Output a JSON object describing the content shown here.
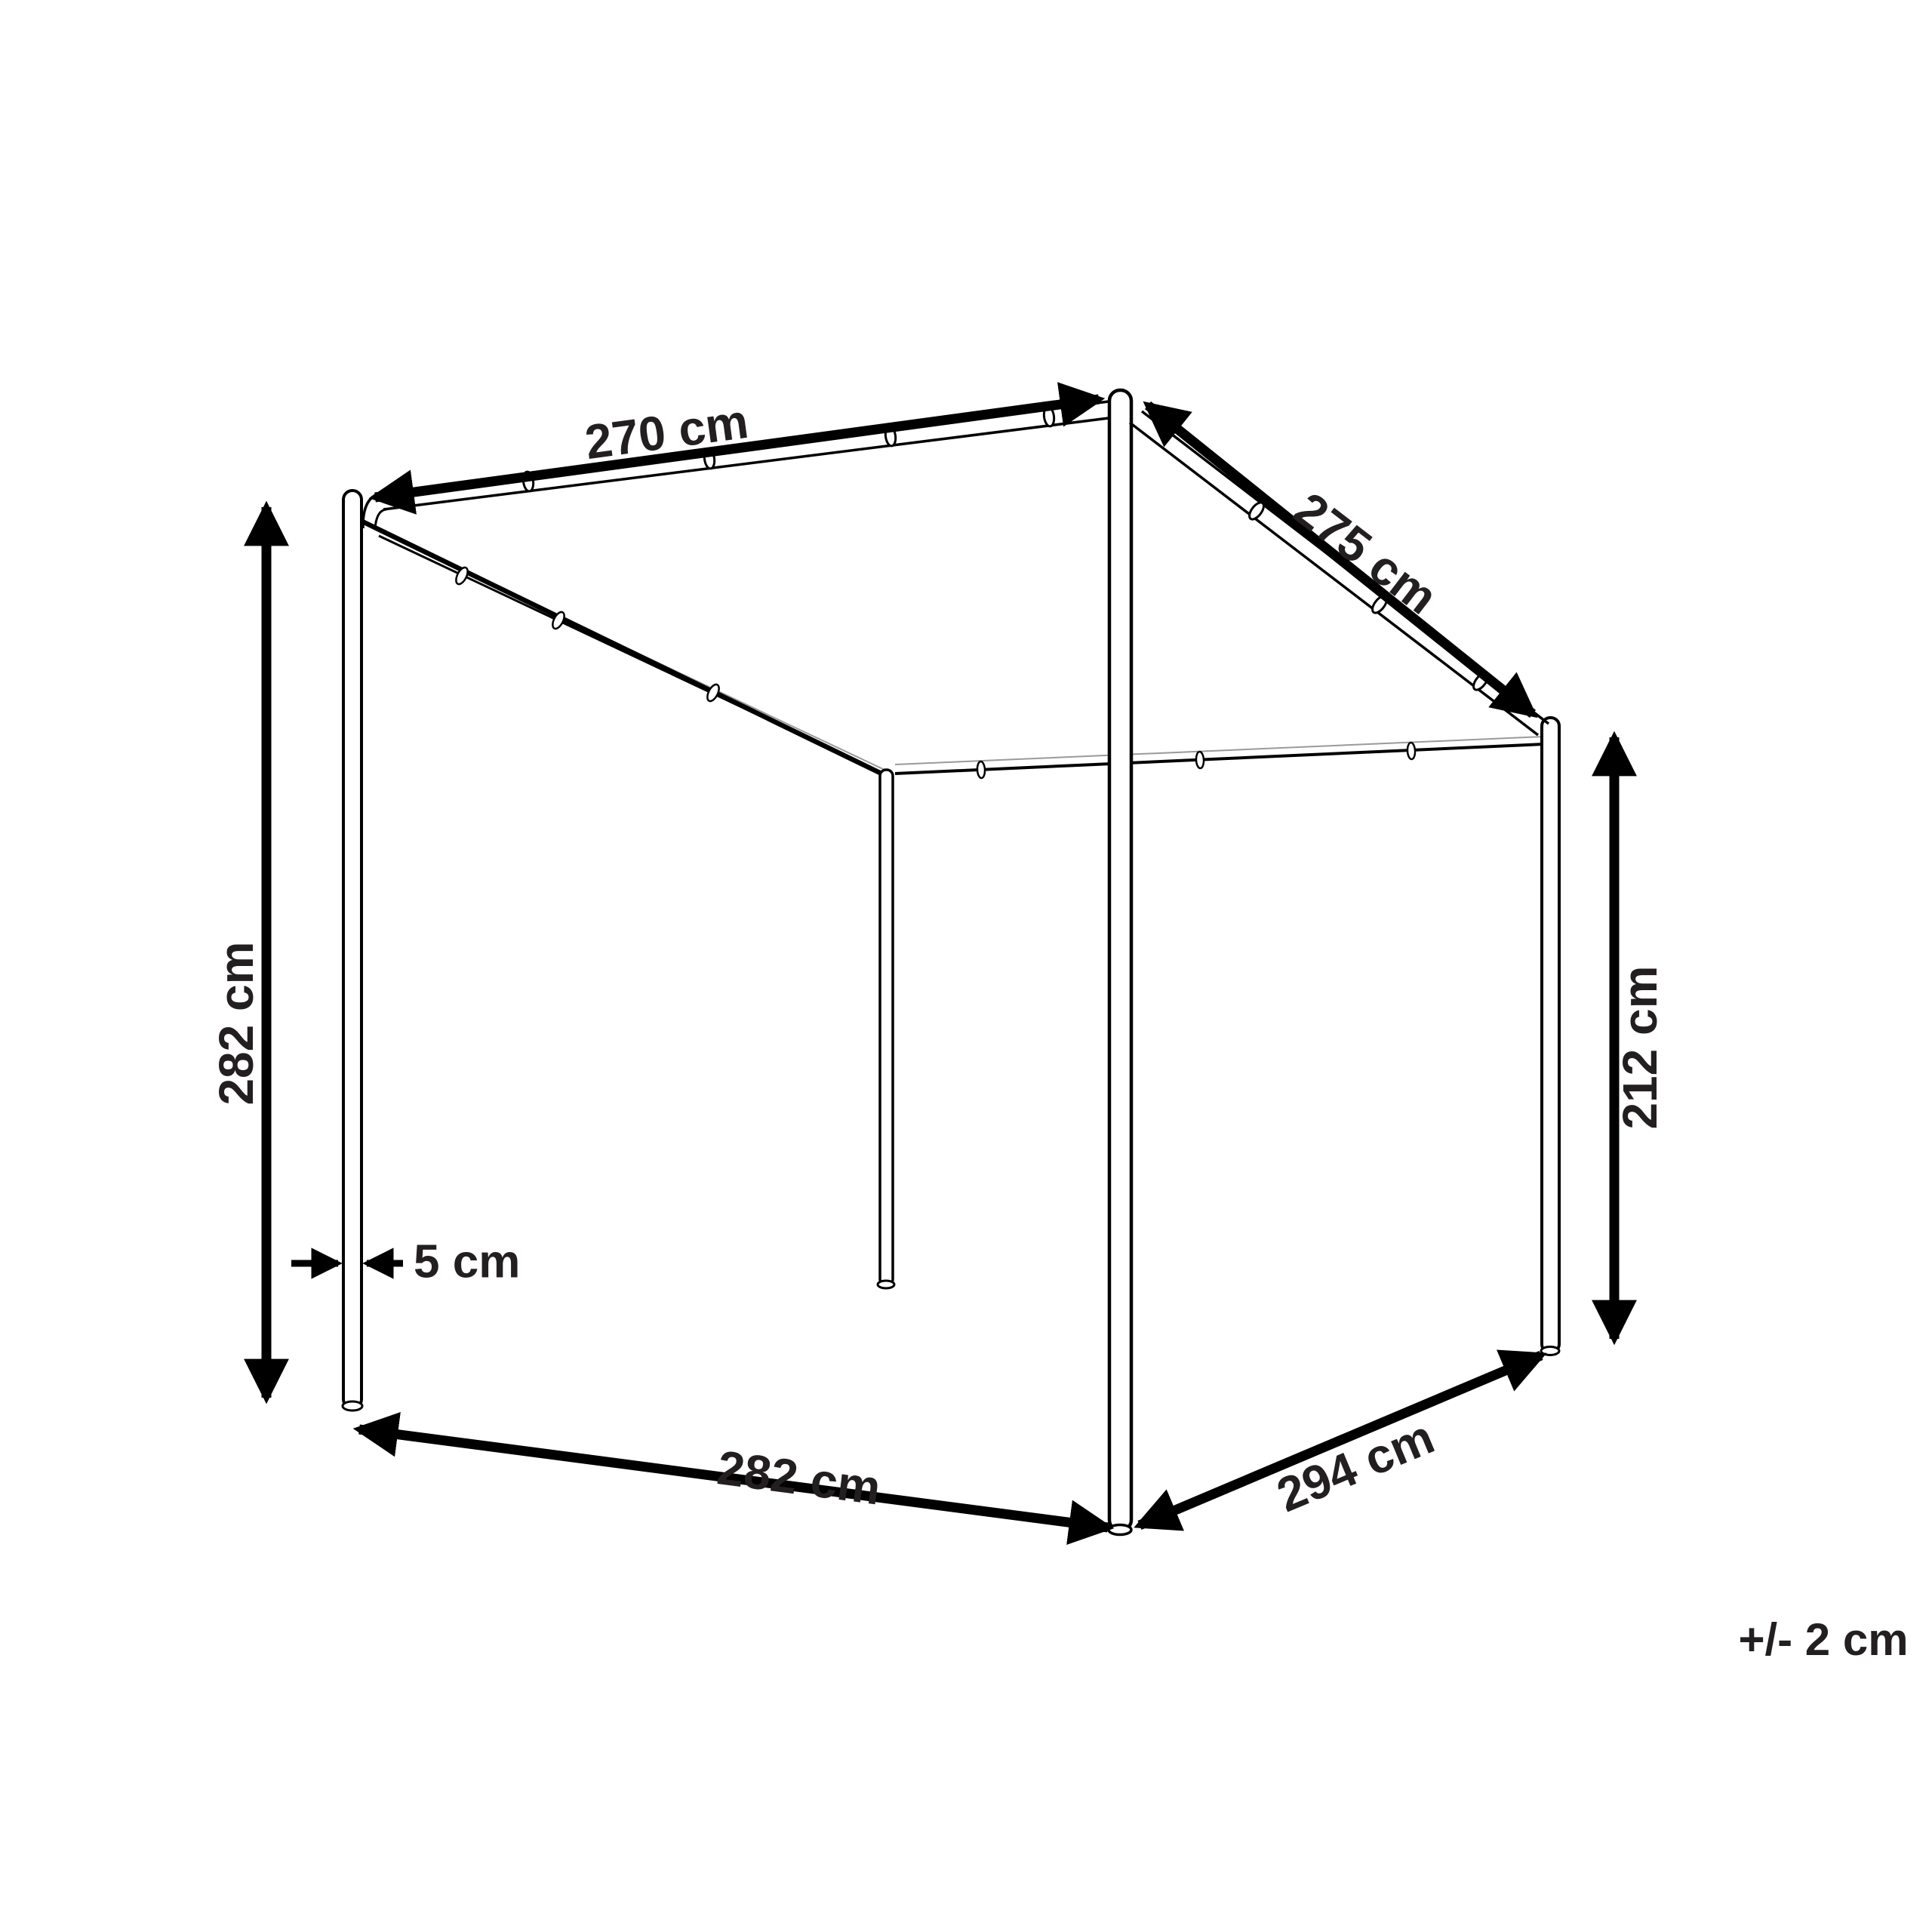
{
  "diagram": {
    "type": "product-dimension-drawing",
    "subject": "wall-mounted canopy / pergola frame",
    "dimensions": {
      "top_front_edge": "270 cm",
      "roof_slope_edge": "275 cm",
      "left_post_height": "282 cm",
      "right_post_height": "212 cm",
      "post_thickness": "5 cm",
      "bottom_front_edge": "282 cm",
      "bottom_side_edge": "294 cm"
    },
    "tolerance_note": "+/- 2 cm",
    "colors": {
      "background": "#ffffff",
      "frame_line": "#000000",
      "fabric_line": "#9a9a9a",
      "label_text": "#231f20"
    }
  }
}
